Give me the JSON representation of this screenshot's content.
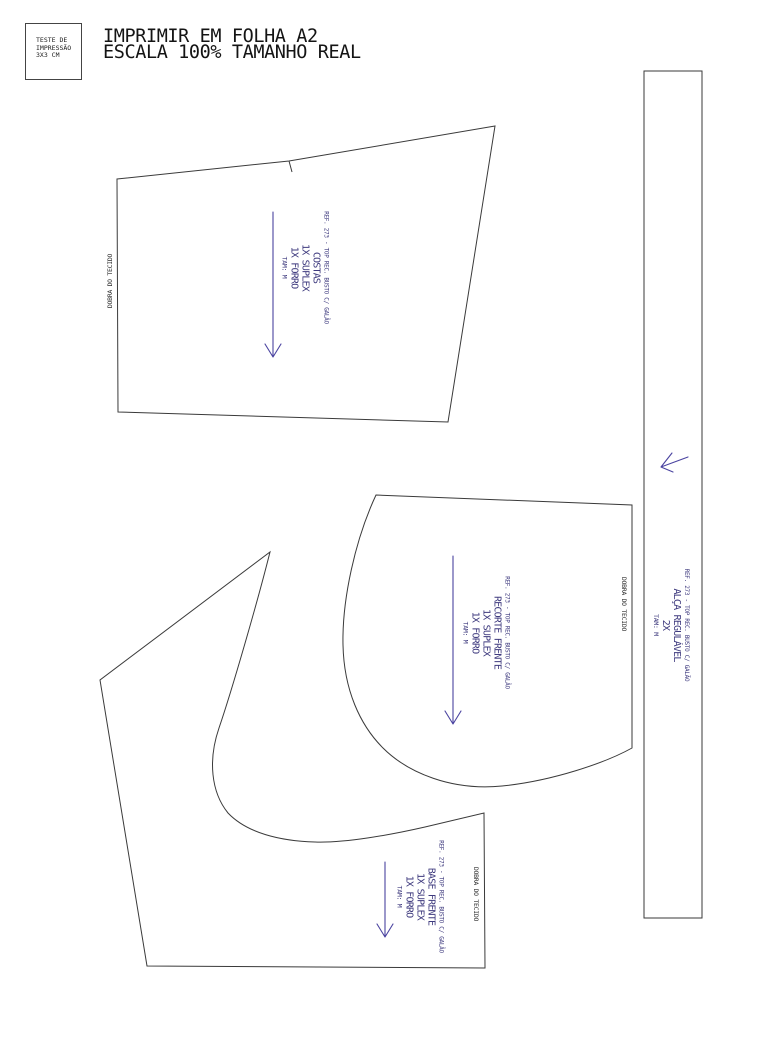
{
  "test_box": {
    "line1": "TESTE DE",
    "line2": "IMPRESSÃO",
    "line3": "3X3 CM"
  },
  "header": {
    "line1": "IMPRIMIR EM FOLHA A2",
    "line2": "ESCALA 100% TAMANHO REAL"
  },
  "pieces": [
    {
      "ref": "REF. 273 - TOP REC. BUSTO C/ GALÃO",
      "name": "COSTAS",
      "qty1": "1X SUPLEX",
      "qty2": "1X FORRO",
      "size": "TAM: M",
      "fold": "DOBRA DO TECIDO"
    },
    {
      "ref": "REF. 273 - TOP REC. BUSTO C/ GALÃO",
      "name": "RECORTE FRENTE",
      "qty1": "1X SUPLEX",
      "qty2": "1X FORRO",
      "size": "TAM: M",
      "fold": "DOBRA DO TECIDO"
    },
    {
      "ref": "REF. 273 - TOP REC. BUSTO C/ GALÃO",
      "name": "BASE FRENTE",
      "qty1": "1X SUPLEX",
      "qty2": "1X FORRO",
      "size": "TAM: M",
      "fold": "DOBRA DO TECIDO"
    },
    {
      "ref": "REF. 273 - TOP REC. BUSTO C/ GALÃO",
      "name": "ALÇA REGULÁVEL",
      "qty1": "2X",
      "size": "TAM: M"
    }
  ],
  "colors": {
    "outline": "#3a3a3a",
    "label_text": "#3e3a7e",
    "arrow": "#4a43a0",
    "background": "#ffffff"
  }
}
